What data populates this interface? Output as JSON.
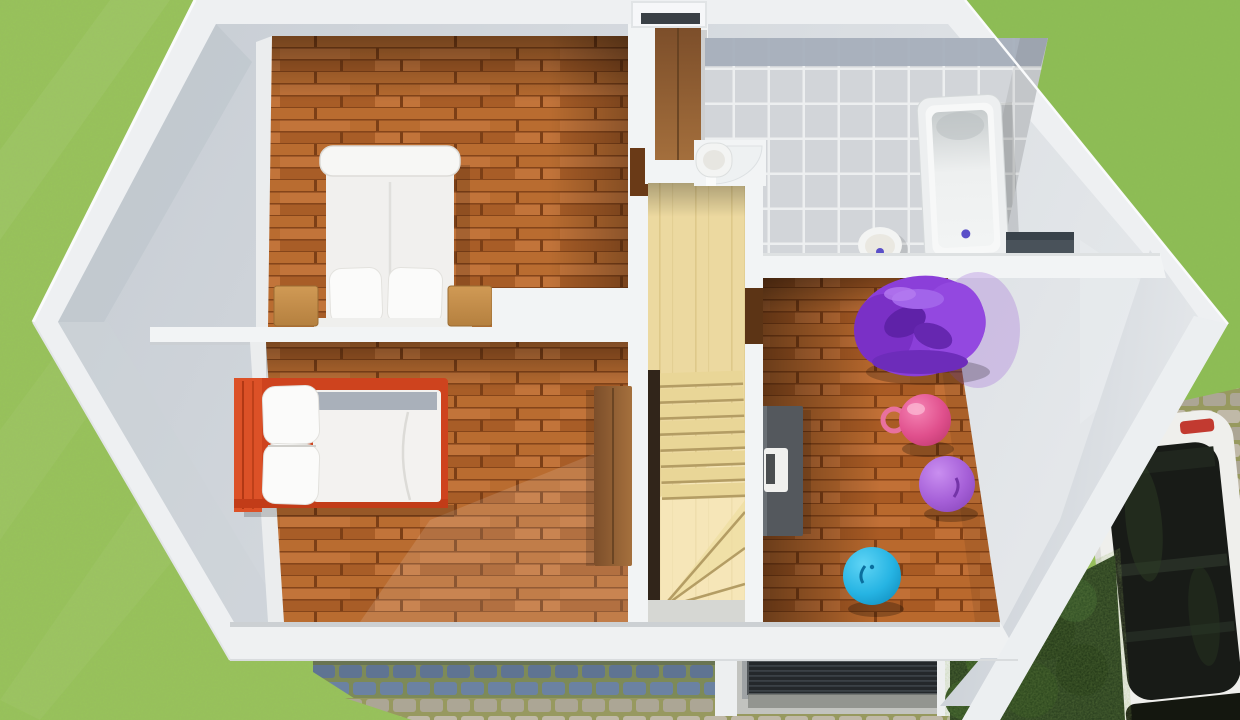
{
  "colors": {
    "grass": "#98c45a",
    "grass_right_shade": "#6fae3e",
    "cobble_joint": "#7d8a58",
    "cobble_stone_blue_a": "#6b82a2",
    "cobble_stone_blue_b": "#5f7492",
    "cobble_stone_tan_a": "#c0b9a8",
    "cobble_stone_tan_b": "#aca695",
    "plank_a": "#b96c30",
    "plank_b": "#a85d27",
    "plank_c": "#c2743a",
    "plank_seam": "#7c3f16",
    "stair_wood": "#ecd9a0",
    "stair_tread": "#e9d697",
    "stair_line": "#b49d64",
    "stair_void": "#31251a",
    "sun_patch": "#fff3cf",
    "tile": "#d2d5d9",
    "tile_grout": "#edeff0",
    "tile_band": "#a6afbc",
    "wall_outer": "#eef0f2",
    "wall_white": "#f2f4f5",
    "wall_face_from": "#c6ccd3",
    "wall_face_to": "#e4e7ea",
    "bed_red": "#ce431e",
    "bed_red_head": "#dc5127",
    "white_fabric": "#f1f0ee",
    "pillow_white": "#fbfbfa",
    "blanket_gray": "#a9b0ba",
    "nightstand_light": "#d09a55",
    "nightstand_dark": "#b5803f",
    "wardrobe_dark": "#7c4e2a",
    "wardrobe_light": "#a5703d",
    "desk_gray": "#54585d",
    "laptop_white": "#f0f0ee",
    "laptop_keys": "#4a4d4f",
    "beanbag_purple": "#8b3fd9",
    "beanbag_fold": "#5f22a8",
    "beanbag_highlight": "#a264ea",
    "ball_pink_hi": "#f583b4",
    "ball_pink_mid": "#e0508d",
    "ball_pink_lo": "#c23a72",
    "ball_lilac_hi": "#c98ef0",
    "ball_lilac_mid": "#a660d8",
    "ball_lilac_lo": "#8b48bd",
    "ball_blue_hi": "#5fd4f5",
    "ball_blue_mid": "#26b4e3",
    "ball_blue_lo": "#118fc0",
    "ring_pink": "#e8719e",
    "tub_white": "#f7f8f8",
    "fixture_white": "#f3f4f3",
    "drain_purple": "#5a4fc8",
    "niche_dark": "#49525a",
    "grate_dark": "#24282b",
    "grate_stripe": "#3b4146",
    "concrete": "#c2c3bf",
    "bush_dark": "#23381b",
    "bush_mid": "#2c4a1f",
    "car_body": "#efefec",
    "car_glass": "#181b17",
    "car_taillight": "#c23a30",
    "window_slot": "#3a4046"
  }
}
